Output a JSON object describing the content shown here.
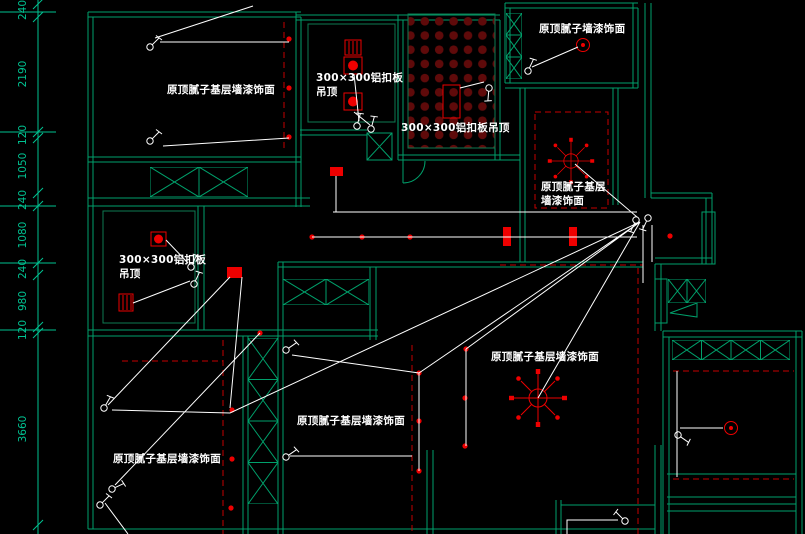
{
  "drawing": {
    "type": "ceiling-lighting-plan",
    "background": "black-cad-viewport"
  },
  "colors": {
    "background": "#000000",
    "wall_green": "#00A06B",
    "grid_green": "#0E7A52",
    "dimension_green": "#00C291",
    "light_red": "#EE0000",
    "dark_red": "#5F0A0A",
    "dashed_red": "#C40000",
    "wire_white": "#FFFFFF"
  },
  "dimensions": {
    "values": [
      "240",
      "2190",
      "120",
      "1050",
      "240",
      "1080",
      "240",
      "980",
      "120",
      "3660"
    ]
  },
  "rooms": {
    "top_left": {
      "finish_label": "原顶腻子基层墙漆饰面"
    },
    "bathroom": {
      "ceiling_label_line1": "300×300铝扣板",
      "ceiling_label_line2": "吊顶"
    },
    "kitchen": {
      "ceiling_label": "300×300铝扣板吊顶"
    },
    "top_right": {
      "finish_label": "原顶腻子墙漆饰面"
    },
    "dining": {
      "finish_label_line1": "原顶腻子基层",
      "finish_label_line2": "墙漆饰面"
    },
    "hall_bath": {
      "ceiling_label_line1": "300×300铝扣板",
      "ceiling_label_line2": "吊顶"
    },
    "bottom_left": {
      "finish_label": "原顶腻子基层墙漆饰面"
    },
    "bottom_middle": {
      "finish_label": "原顶腻子基层墙漆饰面"
    },
    "living": {
      "finish_label": "原顶腻子基层墙漆饰面"
    }
  }
}
